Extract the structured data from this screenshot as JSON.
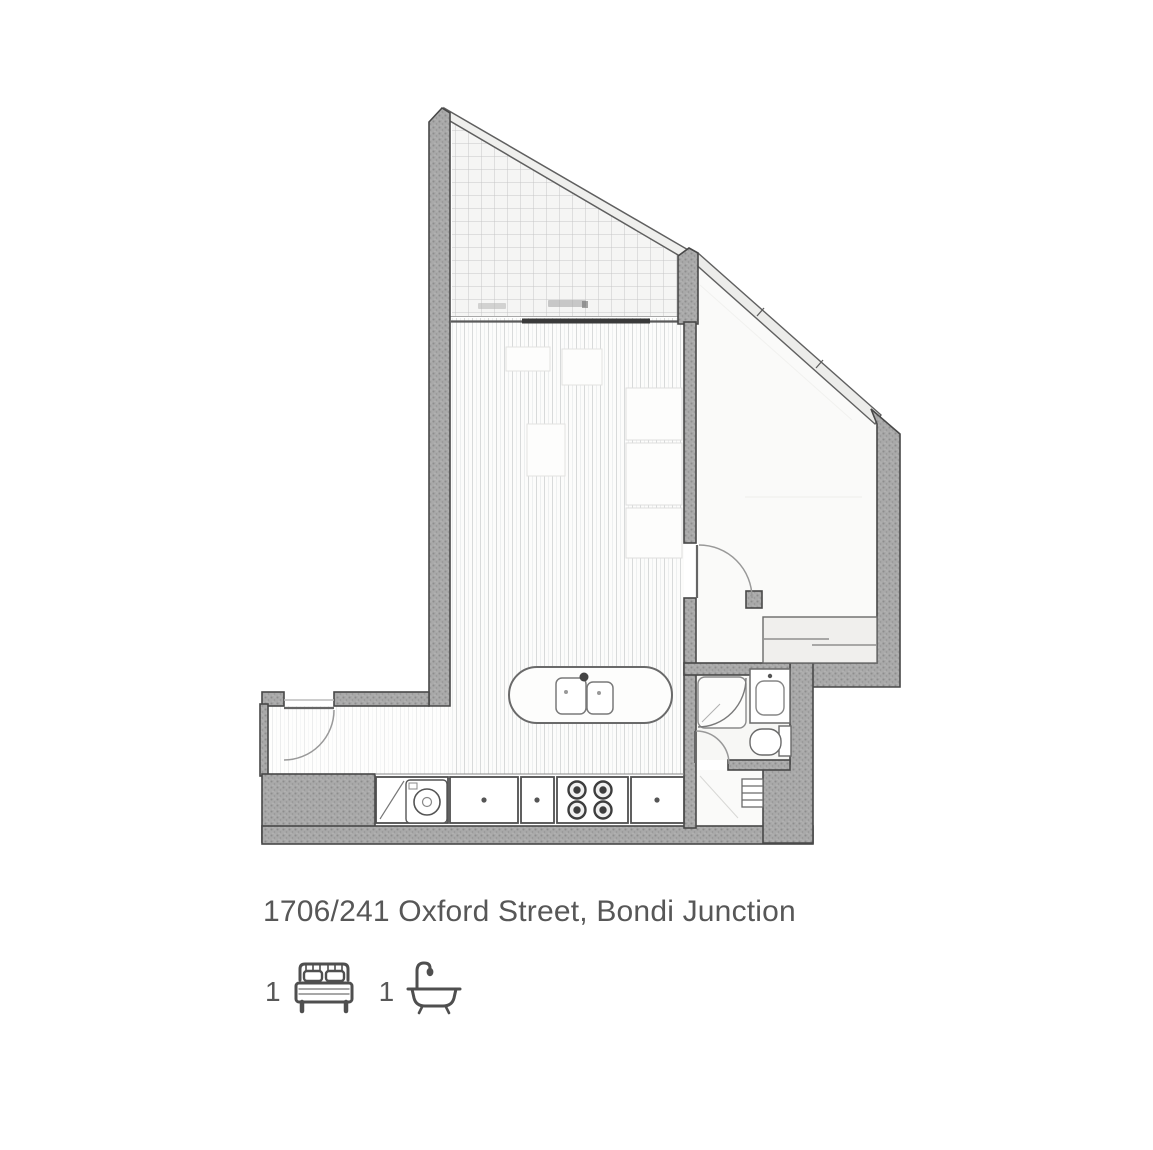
{
  "listing": {
    "address": "1706/241 Oxford Street, Bondi Junction",
    "beds": "1",
    "baths": "1"
  },
  "icons": {
    "bed": "bed-icon",
    "bath": "bath-icon"
  },
  "colors": {
    "background": "#ffffff",
    "wall_fill": "#a4a4a4",
    "wall_outline": "#484848",
    "glass_line": "#5f5f5f",
    "fixture_line": "#6a6a6a",
    "floor_line": "#dcdedd",
    "text": "#575757"
  },
  "floorplan": {
    "type": "apartment-floor-plan",
    "areas": [
      "balcony",
      "living-dining",
      "kitchen",
      "bedroom",
      "wardrobe",
      "bathroom",
      "laundry",
      "entry"
    ]
  }
}
